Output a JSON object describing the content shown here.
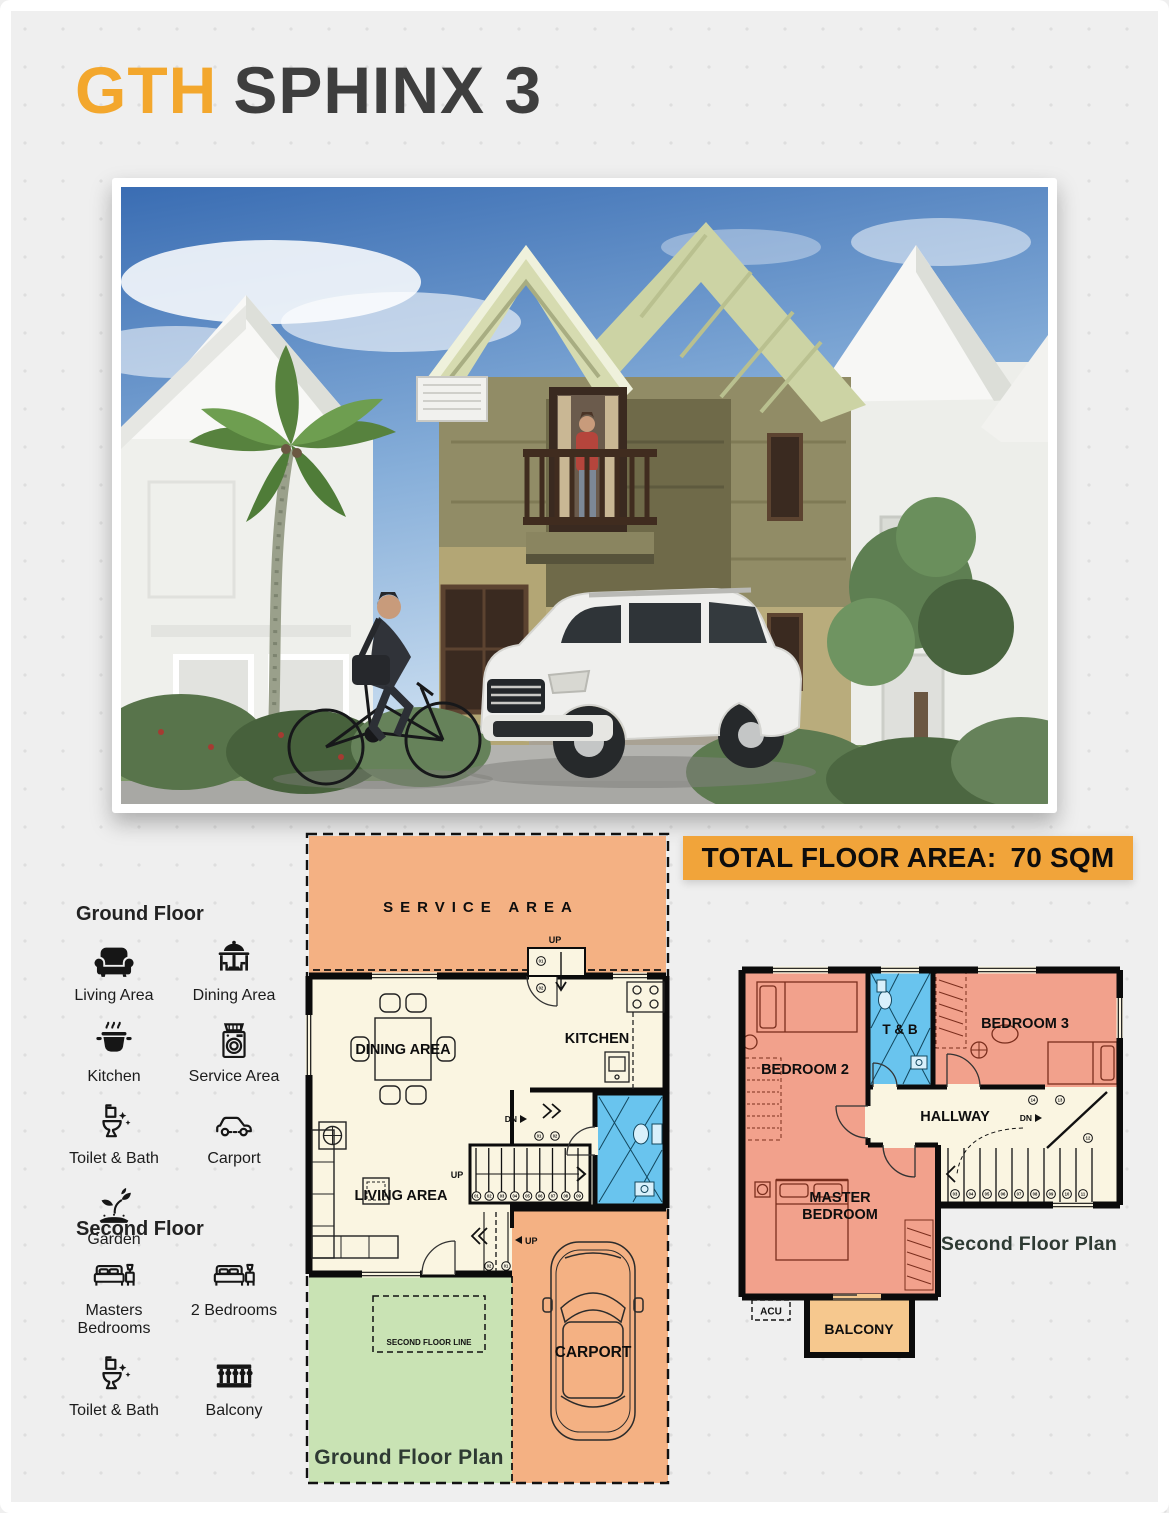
{
  "title": {
    "brand": "GTH",
    "model": "SPHINX 3"
  },
  "banner": {
    "label": "TOTAL FLOOR AREA:",
    "value": "70 SQM"
  },
  "legend": {
    "ground_floor": {
      "heading": "Ground Floor",
      "items": [
        {
          "label": "Living Area",
          "icon": "sofa-icon"
        },
        {
          "label": "Dining Area",
          "icon": "dining-table-icon"
        },
        {
          "label": "Kitchen",
          "icon": "cooking-pot-icon"
        },
        {
          "label": "Service Area",
          "icon": "washing-machine-icon"
        },
        {
          "label": "Toilet & Bath",
          "icon": "toilet-icon"
        },
        {
          "label": "Carport",
          "icon": "car-icon"
        },
        {
          "label": "Garden",
          "icon": "plant-icon"
        }
      ]
    },
    "second_floor": {
      "heading": "Second Floor",
      "items": [
        {
          "label": "Masters Bedrooms",
          "icon": "bed-icon"
        },
        {
          "label": "2 Bedrooms",
          "icon": "bed-icon"
        },
        {
          "label": "Toilet & Bath",
          "icon": "toilet-icon"
        },
        {
          "label": "Balcony",
          "icon": "balustrade-icon"
        }
      ]
    }
  },
  "ground_floor_plan": {
    "caption": "Ground Floor Plan",
    "rooms": {
      "service_area": "SERVICE AREA",
      "dining_area": "DINING AREA",
      "kitchen": "KITCHEN",
      "living_area": "LIVING AREA",
      "carport": "CARPORT"
    },
    "labels": {
      "up": "UP",
      "dn": "DN",
      "second_floor_line": "SECOND FLOOR LINE"
    },
    "service_steps": [
      "01",
      "02"
    ],
    "main_stairs": [
      "01",
      "02",
      "03",
      "04",
      "05",
      "06",
      "07",
      "08",
      "09"
    ],
    "mid_landing": [
      "01",
      "02"
    ],
    "entry_steps": [
      "02",
      "01"
    ]
  },
  "second_floor_plan": {
    "caption": "Second Floor Plan",
    "rooms": {
      "bedroom2": "BEDROOM 2",
      "toilet_bath": "T & B",
      "bedroom3": "BEDROOM 3",
      "hallway": "HALLWAY",
      "master_line1": "MASTER",
      "master_line2": "BEDROOM",
      "balcony": "BALCONY",
      "acu": "ACU"
    },
    "labels": {
      "dn": "DN"
    },
    "stairs": [
      "03",
      "04",
      "05",
      "06",
      "07",
      "08",
      "09",
      "10",
      "11"
    ],
    "landing_top": [
      "14",
      "13"
    ],
    "landing_turn": [
      "12"
    ]
  },
  "colors": {
    "brand_orange": "#F3A72D",
    "banner_orange": "#F1A43A",
    "plan_orange": "#F4B183",
    "plan_green": "#C9E3B4",
    "plan_blue": "#69C4EE",
    "plan_salmon": "#F2A18C",
    "plan_cream": "#FAF5E1",
    "plan_tan": "#F6C88E",
    "title_dark": "#3E3E3E"
  }
}
